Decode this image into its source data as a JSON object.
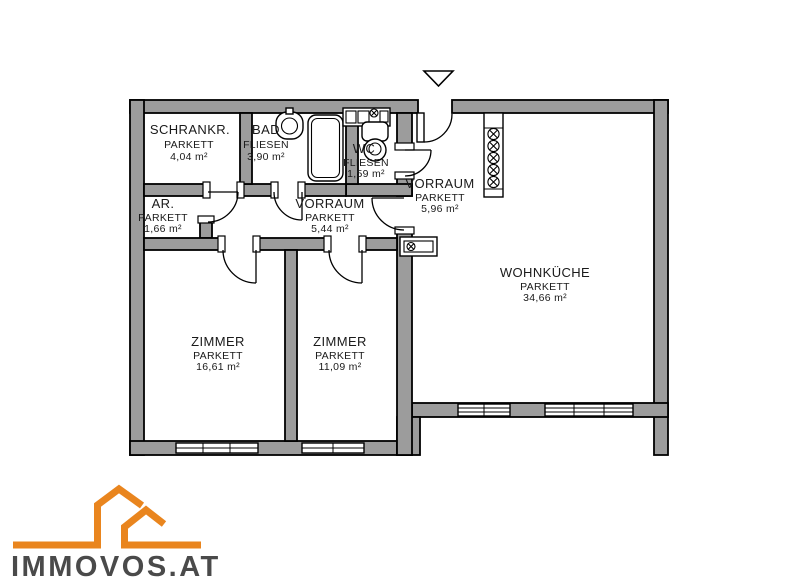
{
  "plan": {
    "rooms": [
      {
        "name": "SCHRANKR.",
        "floor": "PARKETT",
        "area": "4,04 m²"
      },
      {
        "name": "BAD",
        "floor": "FLIESEN",
        "area": "3,90 m²"
      },
      {
        "name": "WC",
        "floor": "FLIESEN",
        "area": "1,59 m²"
      },
      {
        "name": "VORRAUM",
        "floor": "PARKETT",
        "area": "5,96 m²"
      },
      {
        "name": "AR.",
        "floor": "PARKETT",
        "area": "1,66 m²"
      },
      {
        "name": "VORRAUM",
        "floor": "PARKETT",
        "area": "5,44 m²"
      },
      {
        "name": "WOHNKÜCHE",
        "floor": "PARKETT",
        "area": "34,66 m²"
      },
      {
        "name": "ZIMMER",
        "floor": "PARKETT",
        "area": "16,61 m²"
      },
      {
        "name": "ZIMMER",
        "floor": "PARKETT",
        "area": "11,09 m²"
      }
    ]
  },
  "logo": {
    "text": "IMMOVOS.AT"
  },
  "colors": {
    "wall_fill": "#9c9c9c",
    "line": "#000000",
    "logo_orange": "#e9851e",
    "logo_text": "#4a4a4a",
    "background": "#ffffff"
  }
}
